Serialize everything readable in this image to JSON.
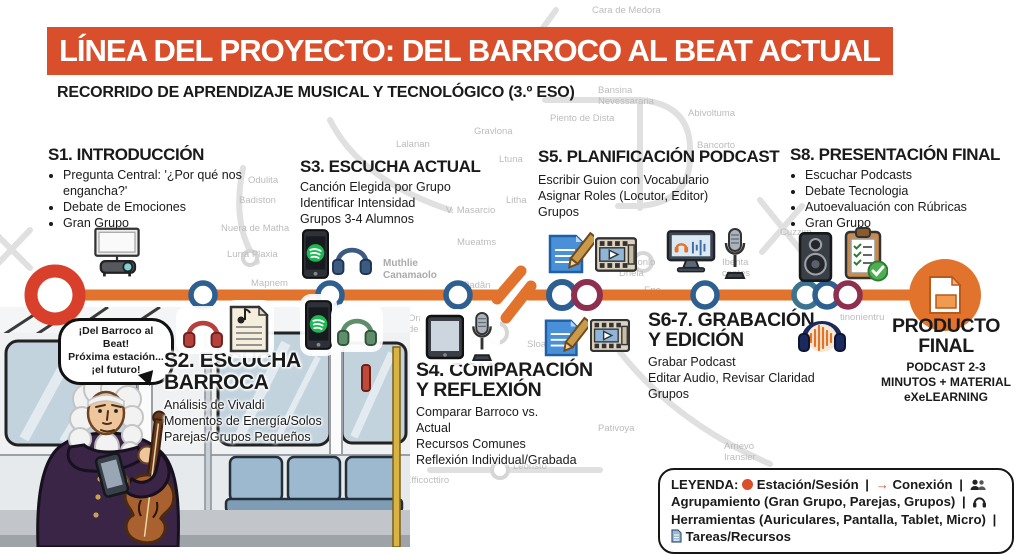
{
  "title": "LÍNEA DEL PROYECTO: DEL BARROCO AL BEAT ACTUAL",
  "subtitle": "RECORRIDO DE APRENDIZAJE MUSICAL Y TECNOLÓGICO (3.º ESO)",
  "colors": {
    "banner": "#d94e2b",
    "line": "#e2732d",
    "terminus_red": "#d8402c",
    "station_blue": "#2e5f91",
    "station_teal": "#3c7390",
    "station_maroon": "#8e2f4f",
    "final_orange": "#e2732d"
  },
  "stations": {
    "s1": {
      "title": "S1. INTRODUCCIÓN",
      "bullets": [
        "Pregunta Central: '¿Por qué nos engancha?'",
        "Debate de Emociones",
        "Gran Grupo"
      ]
    },
    "s2": {
      "title": "S2. ESCUCHA\nBARROCA",
      "lines": "Análisis de Vivaldi\nMomentos de Energía/Solos\nParejas/Grupos Pequeños"
    },
    "s3": {
      "title": "S3. ESCUCHA ACTUAL",
      "lines": "Canción Elegida por Grupo\nIdentificar Intensidad\nGrupos 3-4 Alumnos"
    },
    "s4": {
      "title": "S4. COMPARACIÓN\nY REFLEXIÓN",
      "lines": "Comparar Barroco vs.\nActual\nRecursos Comunes\nReflexión Individual/Grabada"
    },
    "s5": {
      "title": "S5. PLANIFICACIÓN PODCAST",
      "lines": "Escribir Guion con Vocabulario\nAsignar Roles (Locutor, Editor)\nGrupos"
    },
    "s67": {
      "title": "S6-7. GRABACIÓN\nY EDICIÓN",
      "lines": "Grabar Podcast\nEditar Audio, Revisar Claridad\nGrupos"
    },
    "s8": {
      "title": "S8. PRESENTACIÓN FINAL",
      "bullets": [
        "Escuchar Podcasts",
        "Debate Tecnologia",
        "Autoevaluación con Rúbricas",
        "Gran Grupo"
      ]
    },
    "producto": {
      "title": "PRODUCTO\nFINAL",
      "lines": "PODCAST 2-3\nMINUTOS + MATERIAL\neXeLEARNING"
    }
  },
  "speech_bubble": "¡Del Barroco al Beat!\nPróxima estación...\n¡el futuro!",
  "legend": {
    "label": "LEYENDA:",
    "items": [
      {
        "icon": "station-dot-icon",
        "text": "Estación/Sesión"
      },
      {
        "icon": "arrow-icon",
        "text": "Conexión"
      },
      {
        "icon": "people-icon",
        "text": "Agrupamiento (Gran Grupo, Parejas, Grupos)"
      },
      {
        "icon": "headphones-icon",
        "text": "Herramientas (Auriculares, Pantalla, Tablet, Micro)"
      },
      {
        "icon": "doc-icon",
        "text": "Tareas/Recursos"
      }
    ],
    "separator": "|"
  },
  "icons": {
    "s1": [
      "projector-icon"
    ],
    "s2": [
      "headphones-red-icon",
      "sheet-music-icon",
      "phone-spotify-icon",
      "headphones-green-icon"
    ],
    "s3": [
      "phone-spotify-icon",
      "headphones-blue-icon"
    ],
    "s4": [
      "tablet-icon",
      "microphone-icon"
    ],
    "s5": [
      "script-pencil-icon",
      "video-player-icon",
      "computer-audio-icon",
      "microphone-icon"
    ],
    "s67": [
      "script-pencil-icon",
      "video-player-icon",
      "audacity-icon"
    ],
    "s8": [
      "speaker-icon",
      "clipboard-check-icon"
    ],
    "producto": [
      "file-document-icon"
    ]
  },
  "background_labels": [
    {
      "x": 592,
      "y": 6,
      "t": "Cara de Medora"
    },
    {
      "x": 598,
      "y": 86,
      "t": "Bansina\nNevessararia"
    },
    {
      "x": 550,
      "y": 114,
      "t": "Piento de Dista"
    },
    {
      "x": 688,
      "y": 109,
      "t": "Abivoltuma"
    },
    {
      "x": 474,
      "y": 127,
      "t": "Gravlona"
    },
    {
      "x": 697,
      "y": 141,
      "t": "Bancorto"
    },
    {
      "x": 396,
      "y": 140,
      "t": "Lalanan"
    },
    {
      "x": 499,
      "y": 155,
      "t": "Ltuna"
    },
    {
      "x": 506,
      "y": 196,
      "t": "Litha"
    },
    {
      "x": 248,
      "y": 176,
      "t": "Odulita"
    },
    {
      "x": 239,
      "y": 196,
      "t": "Badiston"
    },
    {
      "x": 446,
      "y": 206,
      "t": "V. Masarcio"
    },
    {
      "x": 221,
      "y": 224,
      "t": "Nuera de Matha"
    },
    {
      "x": 457,
      "y": 238,
      "t": "Mueatms"
    },
    {
      "x": 227,
      "y": 250,
      "t": "Lurra Plaxia"
    },
    {
      "x": 383,
      "y": 258,
      "t": "Muthlie\nCanamaolo",
      "bold": true
    },
    {
      "x": 251,
      "y": 279,
      "t": "Mapnem"
    },
    {
      "x": 463,
      "y": 281,
      "t": "Padãn"
    },
    {
      "x": 619,
      "y": 258,
      "t": "MuLonlo\nDnela"
    },
    {
      "x": 722,
      "y": 258,
      "t": "Ibenta\ncontes"
    },
    {
      "x": 780,
      "y": 228,
      "t": "Cuzzim"
    },
    {
      "x": 840,
      "y": 313,
      "t": "tinonientru"
    },
    {
      "x": 408,
      "y": 314,
      "t": "Orar\nde le"
    },
    {
      "x": 527,
      "y": 340,
      "t": "Sloa"
    },
    {
      "x": 644,
      "y": 286,
      "t": "Ene"
    },
    {
      "x": 598,
      "y": 424,
      "t": "Pativoya"
    },
    {
      "x": 724,
      "y": 442,
      "t": "Arrievo\nIransier"
    },
    {
      "x": 513,
      "y": 462,
      "t": "Leoristo"
    },
    {
      "x": 405,
      "y": 476,
      "t": "Efficocttiro"
    }
  ]
}
